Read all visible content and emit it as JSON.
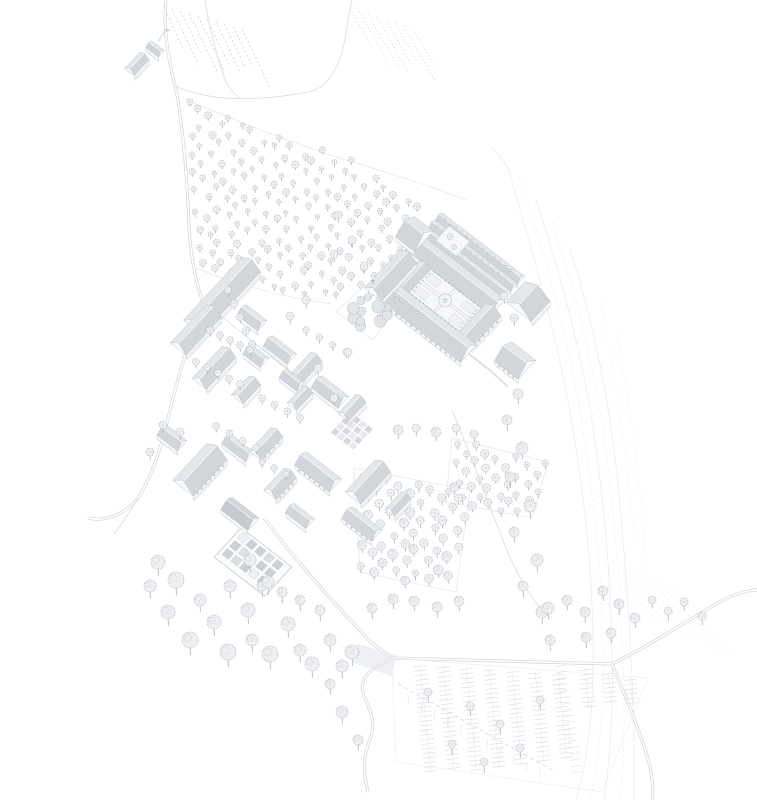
{
  "palette": {
    "background": "#ffffff",
    "outline": "#bcc2c9",
    "lineFaint": "#e3e6ea",
    "road": "#ccd1d7",
    "roofLight": "#e4e7ea",
    "roofMid": "#d2d6db",
    "roofDark": "#c6cbd1",
    "wall": "#f8f9fa",
    "window": "#9aa1ab",
    "treeStroke": "#b4bac2",
    "treeFill": "#edeff2",
    "treeTrunk": "#aeb4bd",
    "gardenBed": "#ccd1d7",
    "courtPath": "#eef0f3",
    "shadow": "#d9dde2",
    "contour": "#e6e9ec"
  },
  "iso": {
    "u": [
      0.79,
      0.61
    ],
    "v": [
      -0.68,
      0.73
    ]
  },
  "farmstead": {
    "buildings": [
      [
        137,
        64,
        22,
        12,
        "v"
      ],
      [
        155,
        49,
        16,
        9,
        "u"
      ]
    ],
    "flag": [
      [
        158,
        42
      ],
      [
        166,
        29
      ]
    ]
  },
  "vineyards": [
    {
      "x": 163,
      "y": 6,
      "n": 10,
      "step": [
        8.8,
        2.6
      ],
      "vec": [
        24,
        50
      ],
      "dash": "2 2.4"
    },
    {
      "x": 350,
      "y": 8,
      "n": 8,
      "step": [
        9,
        3
      ],
      "vec": [
        26,
        46
      ],
      "dash": "1.2 2.6"
    }
  ],
  "roads": {
    "main": [
      "M166,0 C163,28 168,58 175,86 C181,110 187,170 189,225 C190,248 194,276 202,300",
      "M202,300 C194,330 180,368 172,402 C165,432 156,470 138,498 C124,516 102,522 88,518",
      "M264,518 C286,548 320,588 354,624 C366,638 378,650 394,658",
      "M394,658 C460,660 540,662 612,664",
      "M612,664 C648,646 686,622 716,604 C734,594 748,590 757,590",
      "M612,664 C622,688 634,716 646,752 C652,772 654,788 652,800",
      "M392,660 C368,668 358,680 364,696 C372,714 376,724 369,742 C363,758 363,772 368,792"
    ],
    "lane": [
      "M175,86 C215,104 266,100 308,92 C332,88 344,58 348,18",
      "M348,18 C350,12 351,6 352,0",
      "M205,0 C209,26 215,50 223,74 C227,86 233,94 241,99",
      "M138,498 C130,512 122,524 114,534",
      "M202,300 C228,322 258,346 288,370",
      "M452,410 C470,454 488,502 506,548 C516,572 528,594 546,616"
    ],
    "faint": [
      "M186,100 C240,122 300,146 352,162 C396,175 436,188 466,200",
      "M196,268 C240,286 288,298 332,304"
    ]
  },
  "contours": [
    {
      "d": "M508,168 C528,236 556,330 572,424 C588,518 596,608 592,700 C590,740 584,772 576,800"
    },
    {
      "d": "M520,180 C544,252 570,344 584,436 C598,528 606,616 602,706 C600,744 596,776 590,800",
      "dash": "2.2 3"
    },
    {
      "d": "M536,200 C560,272 584,360 596,448 C608,536 614,622 612,710 C610,748 608,778 604,800"
    },
    {
      "d": "M552,222 C576,294 598,380 608,466 C618,552 624,636 624,722 C624,752 622,780 620,800",
      "dash": "2.2 3"
    },
    {
      "d": "M570,248 C592,318 610,400 618,484 C626,568 632,650 634,734 C634,760 634,782 634,800"
    },
    {
      "d": "M600,300 C616,380 628,460 634,540",
      "dash": "1.2 2.6"
    },
    {
      "d": "M616,332 C632,412 642,492 646,572",
      "dash": "1.2 2.6"
    },
    {
      "d": "M492,148 C500,156 506,164 510,172"
    }
  ],
  "terraces": {
    "x0": 598,
    "y0": 556,
    "dx": 12,
    "dy": 5,
    "n": 7,
    "vec": [
      62,
      68
    ],
    "dash": "1.2 2.6"
  },
  "orchards": [
    {
      "poly": [
        [
          188,
          100
        ],
        [
          348,
          158
        ],
        [
          428,
          200
        ],
        [
          424,
          292
        ],
        [
          300,
          296
        ],
        [
          194,
          270
        ]
      ],
      "s": 13.5,
      "jitter": 3.2,
      "r": [
        2.2,
        3.6
      ],
      "trunk": 4,
      "seed": 7
    },
    {
      "poly": [
        [
          354,
          468
        ],
        [
          470,
          490
        ],
        [
          456,
          592
        ],
        [
          360,
          572
        ]
      ],
      "s": 14.5,
      "jitter": 2.6,
      "r": [
        3.2,
        5
      ],
      "trunk": 6,
      "seed": 11
    },
    {
      "poly": [
        [
          452,
          438
        ],
        [
          548,
          462
        ],
        [
          532,
          518
        ],
        [
          446,
          502
        ]
      ],
      "s": 13,
      "jitter": 2.4,
      "r": [
        2.8,
        4.2
      ],
      "trunk": 5,
      "seed": 23
    }
  ],
  "fieldOutlines": [
    [
      [
        354,
        468
      ],
      [
        470,
        490
      ],
      [
        456,
        592
      ],
      [
        360,
        572
      ]
    ],
    [
      [
        452,
        438
      ],
      [
        548,
        462
      ],
      [
        532,
        518
      ],
      [
        446,
        502
      ]
    ]
  ],
  "village": [
    [
      222,
      296,
      86,
      24,
      "v",
      ""
    ],
    [
      196,
      330,
      52,
      20,
      "v",
      ""
    ],
    [
      252,
      318,
      26,
      14,
      "u",
      ""
    ],
    [
      214,
      368,
      44,
      18,
      "v",
      ""
    ],
    [
      256,
      356,
      22,
      13,
      "u",
      ""
    ],
    [
      246,
      390,
      26,
      15,
      "v",
      ""
    ],
    [
      280,
      350,
      30,
      14,
      "u",
      ""
    ],
    [
      306,
      368,
      30,
      15,
      "v",
      ""
    ],
    [
      330,
      392,
      34,
      16,
      "u",
      ""
    ],
    [
      300,
      398,
      24,
      12,
      "v",
      ""
    ],
    [
      352,
      408,
      26,
      13,
      "v",
      ""
    ],
    [
      172,
      438,
      26,
      14,
      "u",
      ""
    ],
    [
      200,
      470,
      50,
      26,
      "v",
      "win"
    ],
    [
      238,
      448,
      30,
      13,
      "u",
      ""
    ],
    [
      266,
      444,
      32,
      15,
      "v",
      "win"
    ],
    [
      240,
      514,
      34,
      17,
      "u",
      "dark"
    ],
    [
      280,
      484,
      30,
      16,
      "v",
      "win"
    ],
    [
      318,
      472,
      44,
      18,
      "u",
      "win"
    ],
    [
      368,
      482,
      44,
      20,
      "v",
      ""
    ],
    [
      362,
      524,
      38,
      16,
      "u",
      "win"
    ],
    [
      398,
      504,
      24,
      12,
      "v",
      ""
    ],
    [
      300,
      516,
      26,
      13,
      "u",
      ""
    ],
    [
      292,
      380,
      22,
      12,
      "u",
      "hatch"
    ]
  ],
  "streetTreeRows": [
    {
      "a": [
        228,
        290
      ],
      "b": [
        252,
        344
      ],
      "n": 5,
      "r": 3.6
    },
    {
      "a": [
        210,
        330
      ],
      "b": [
        250,
        350
      ],
      "n": 5,
      "r": 3.4
    },
    {
      "a": [
        196,
        362
      ],
      "b": [
        240,
        384
      ],
      "n": 5,
      "r": 3.4
    },
    {
      "a": [
        262,
        398
      ],
      "b": [
        300,
        418
      ],
      "n": 4,
      "r": 3.4
    },
    {
      "a": [
        216,
        426
      ],
      "b": [
        256,
        448
      ],
      "n": 4,
      "r": 3.4
    },
    {
      "a": [
        306,
        330
      ],
      "b": [
        346,
        352
      ],
      "n": 4,
      "r": 3.2
    },
    {
      "a": [
        262,
        462
      ],
      "b": [
        286,
        474
      ],
      "n": 3,
      "r": 3.2
    }
  ],
  "singleTrees": [
    [
      338,
      215,
      4,
      6
    ],
    [
      352,
      240,
      4,
      6
    ],
    [
      334,
      254,
      4,
      6
    ],
    [
      364,
      266,
      4,
      5
    ],
    [
      306,
      300,
      4,
      6
    ],
    [
      290,
      316,
      4,
      6
    ],
    [
      318,
      368,
      4,
      6
    ],
    [
      334,
      398,
      4,
      6
    ],
    [
      348,
      352,
      4,
      5
    ],
    [
      398,
      430,
      5,
      7
    ],
    [
      416,
      428,
      4,
      6
    ],
    [
      436,
      432,
      5,
      7
    ],
    [
      456,
      428,
      4,
      6
    ],
    [
      474,
      434,
      4,
      6
    ],
    [
      504,
      296,
      4,
      6
    ],
    [
      514,
      318,
      4,
      6
    ],
    [
      518,
      394,
      5,
      8
    ],
    [
      507,
      420,
      5,
      9
    ],
    [
      522,
      448,
      6,
      9
    ],
    [
      510,
      477,
      5,
      9
    ],
    [
      530,
      506,
      6,
      10
    ],
    [
      514,
      532,
      5,
      9
    ],
    [
      537,
      560,
      6,
      10
    ],
    [
      523,
      586,
      5,
      9
    ],
    [
      542,
      612,
      6,
      10
    ],
    [
      550,
      640,
      5,
      9
    ],
    [
      352,
      652,
      7,
      11
    ],
    [
      372,
      608,
      5,
      9
    ],
    [
      393,
      599,
      5,
      8
    ],
    [
      414,
      601,
      5,
      8
    ],
    [
      437,
      607,
      5,
      9
    ],
    [
      459,
      601,
      5,
      8
    ],
    [
      548,
      608,
      6,
      9
    ],
    [
      567,
      600,
      5,
      8
    ],
    [
      585,
      612,
      5,
      9
    ],
    [
      603,
      591,
      5,
      8
    ],
    [
      619,
      604,
      5,
      9
    ],
    [
      635,
      618,
      5,
      8
    ],
    [
      586,
      637,
      5,
      9
    ],
    [
      611,
      633,
      5,
      8
    ],
    [
      652,
      600,
      4,
      7
    ],
    [
      668,
      611,
      4,
      8
    ],
    [
      684,
      602,
      4,
      7
    ],
    [
      702,
      616,
      4,
      8
    ],
    [
      428,
      692,
      4,
      8
    ],
    [
      470,
      706,
      4,
      8
    ],
    [
      500,
      724,
      4,
      8
    ],
    [
      452,
      744,
      4,
      9
    ],
    [
      484,
      762,
      4,
      9
    ],
    [
      520,
      748,
      4,
      8
    ],
    [
      540,
      700,
      4,
      8
    ],
    [
      330,
      684,
      5,
      9
    ],
    [
      342,
      712,
      6,
      10
    ],
    [
      358,
      740,
      5,
      9
    ],
    [
      158,
      562,
      7,
      11
    ],
    [
      150,
      586,
      6,
      10
    ],
    [
      176,
      580,
      8,
      12
    ],
    [
      168,
      612,
      7,
      11
    ],
    [
      190,
      640,
      8,
      12
    ],
    [
      200,
      600,
      6,
      10
    ],
    [
      214,
      622,
      7,
      11
    ],
    [
      230,
      586,
      6,
      10
    ],
    [
      228,
      652,
      8,
      12
    ],
    [
      248,
      610,
      7,
      11
    ],
    [
      252,
      640,
      6,
      10
    ],
    [
      262,
      586,
      5,
      9
    ],
    [
      270,
      654,
      8,
      12
    ],
    [
      288,
      624,
      7,
      11
    ],
    [
      300,
      650,
      6,
      10
    ],
    [
      312,
      664,
      7,
      11
    ],
    [
      330,
      640,
      6,
      10
    ],
    [
      342,
      666,
      6,
      10
    ],
    [
      282,
      592,
      5,
      9
    ],
    [
      300,
      600,
      5,
      9
    ],
    [
      320,
      610,
      5,
      9
    ],
    [
      250,
      560,
      6,
      10
    ],
    [
      268,
      582,
      6,
      10
    ],
    [
      163,
      425,
      4,
      6
    ],
    [
      180,
      432,
      4,
      6
    ],
    [
      150,
      452,
      4,
      6
    ]
  ],
  "monastery": {
    "origin": [
      436,
      208
    ],
    "wings": [
      {
        "p": 8,
        "q": 0,
        "pl": 104,
        "ql": 10,
        "axis": "u",
        "dormers": true
      },
      {
        "p": 8,
        "q": 10,
        "pl": 104,
        "ql": 10,
        "axis": "u",
        "dormers": true
      },
      {
        "p": 8,
        "q": 20,
        "pl": 104,
        "ql": 10,
        "axis": "u",
        "dormers": false
      },
      {
        "p": 6,
        "q": 30,
        "pl": 108,
        "ql": 22,
        "axis": "u",
        "dormers": false
      },
      {
        "p": 24,
        "q": 52,
        "pl": 14,
        "ql": 36,
        "axis": "v",
        "win": false
      },
      {
        "p": 102,
        "q": 46,
        "pl": 20,
        "ql": 44,
        "axis": "v",
        "win": true
      },
      {
        "p": 24,
        "q": 84,
        "pl": 100,
        "ql": 24,
        "axis": "u",
        "win": true,
        "dormers": true
      },
      {
        "p": -10,
        "q": 20,
        "pl": 24,
        "ql": 28,
        "axis": "u"
      },
      {
        "p": 116,
        "q": 4,
        "pl": 32,
        "ql": 28,
        "axis": "v"
      },
      {
        "p": 148,
        "q": 60,
        "pl": 30,
        "ql": 26,
        "axis": "u",
        "win": true
      }
    ],
    "church": {
      "p": 2,
      "q": 56,
      "pl": 22,
      "ql": 52
    },
    "courtyard": {
      "p1": 38,
      "q1": 52,
      "p2": 102,
      "q2": 84
    },
    "smallCourt": {
      "p1": 22,
      "q1": 6,
      "p2": 48,
      "q2": 26
    },
    "terrace": [
      [
        0,
        108
      ],
      [
        40,
        108
      ],
      [
        44,
        144
      ],
      [
        -2,
        144
      ]
    ],
    "gardenCluster": {
      "pRange": [
        2,
        38
      ],
      "qRange": [
        110,
        142
      ],
      "n": 13,
      "seed": 31
    },
    "wall": {
      "pts": [
        [
          124,
          96
        ],
        [
          152,
          96
        ],
        [
          176,
          98
        ]
      ],
      "hatchN": 8
    }
  },
  "parking": {
    "lot": [
      [
        392,
        658
      ],
      [
        648,
        678
      ],
      [
        602,
        792
      ],
      [
        396,
        762
      ]
    ],
    "spines": {
      "x0": 420,
      "y0": 664,
      "dx": 23,
      "dy": 1.5,
      "dir": [
        0.1,
        0.995
      ],
      "lens": [
        108,
        106,
        104,
        100,
        96,
        92,
        86
      ]
    },
    "tick": 6.5,
    "step": 4.6,
    "rightRows": [
      [
        585,
        668,
        40
      ],
      [
        608,
        672,
        34
      ],
      [
        630,
        678,
        28
      ]
    ],
    "hatch": {
      "a": [
        560,
        666
      ],
      "b": [
        578,
        772
      ],
      "len": 10,
      "n": 17
    },
    "aisle": {
      "a": [
        398,
        684
      ],
      "b": [
        556,
        772
      ],
      "dash": "4 3.2",
      "herringN": 11
    }
  },
  "junction": [
    [
      358,
      644
    ],
    [
      396,
      656
    ],
    [
      392,
      676
    ],
    [
      352,
      662
    ]
  ],
  "walledGarden": {
    "c": [
      253,
      562
    ],
    "pl": 64,
    "ql": 40,
    "bedSize": 8,
    "bedStep": 11,
    "cols": 5,
    "rows": 3,
    "seed": 17
  },
  "smallBeds": {
    "c": [
      352,
      432
    ],
    "cols": 4,
    "rows": 4,
    "size": 5.5,
    "step": 7.5
  }
}
